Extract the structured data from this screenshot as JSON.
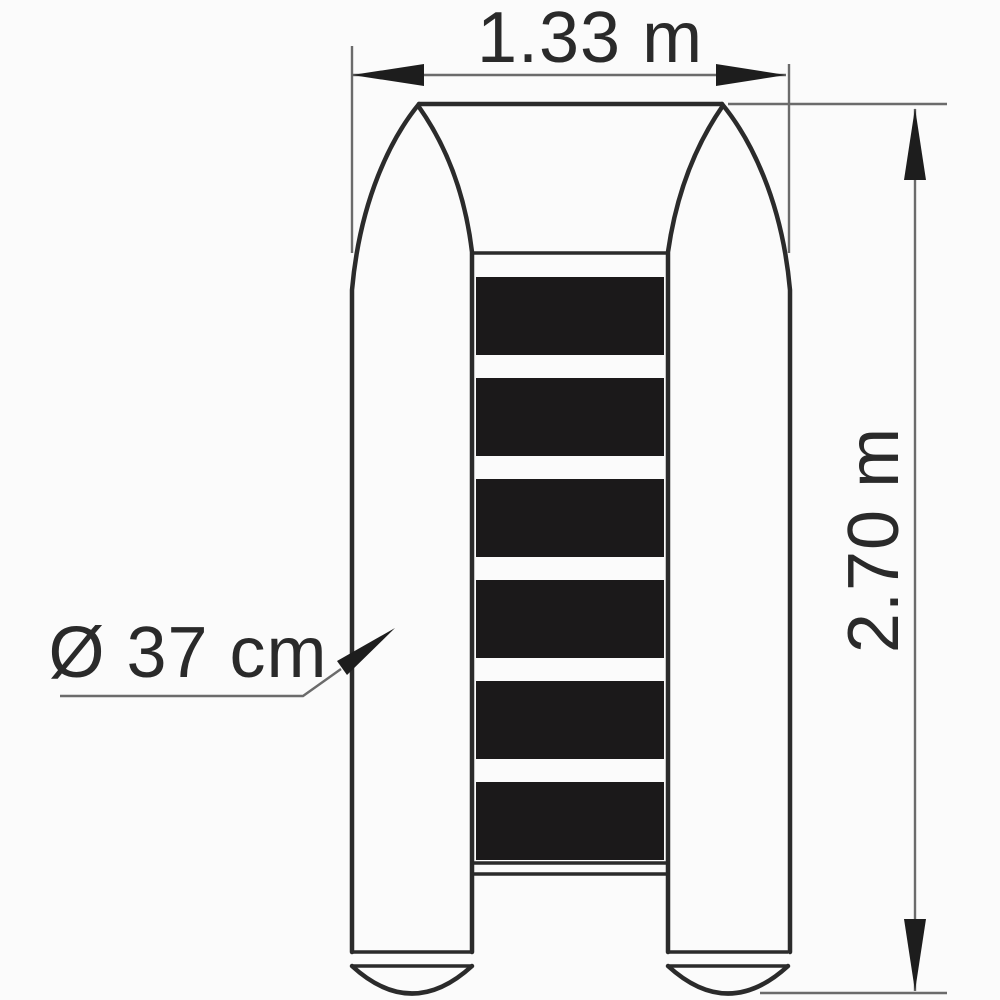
{
  "drawing": {
    "subject": "inflatable-boat-top-view",
    "labels": {
      "width": "1.33 m",
      "length": "2.70 m",
      "tube_diameter": "Ø 37 cm"
    },
    "floor": {
      "slat_count": 6
    },
    "colors": {
      "outline": "#2b2b2b",
      "slat": "#1b191a",
      "dimension_line": "#6b6b6b",
      "arrow": "#1d1d1d",
      "text": "#2a2a2a",
      "background": "#fbfbfb"
    }
  }
}
